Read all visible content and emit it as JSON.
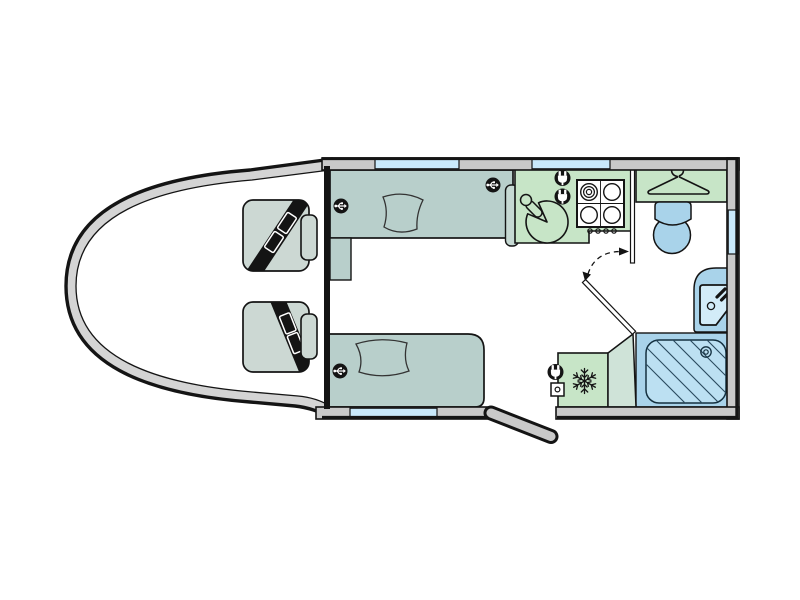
{
  "diagram": {
    "type": "motorhome-floorplan-top-view",
    "colors": {
      "outline": "#141414",
      "thin_line": "#2a2a2a",
      "wall_gray": "#c9c9c9",
      "cab_gray": "#d4d4d4",
      "floor_white": "#ffffff",
      "sofa_teal": "#b8cfcb",
      "sofa_teal_light": "#c6d9d3",
      "seat_gray_green": "#ccd8d3",
      "kitchen_mint": "#c7e5c7",
      "corner_unit_green": "#cfe3d8",
      "fixture_blue": "#a9d3ea",
      "shower_tray_blue": "#bce0f2",
      "basin_inner_blue": "#d3ecf8",
      "window_blue": "#c9e9fb",
      "icon_black": "#141414",
      "icon_white": "#ffffff",
      "hatch_blue": "#2a4a5e"
    },
    "zones": [
      {
        "name": "cab",
        "features": [
          "driver-seat-with-seatbelt",
          "passenger-seat-with-seatbelt",
          "headrests"
        ]
      },
      {
        "name": "lounge",
        "features": [
          "sofa-front-wall",
          "sofa-rear-wall",
          "cushion-x2",
          "usb-outlet-x3",
          "side-unit"
        ]
      },
      {
        "name": "kitchen",
        "features": [
          "round-sink-with-tap",
          "hob-4-burner",
          "hob-control-knobs-x4",
          "power-outlet-x2"
        ]
      },
      {
        "name": "wardrobe",
        "features": [
          "clothes-hanger"
        ]
      },
      {
        "name": "washroom",
        "features": [
          "toilet",
          "washbasin-with-tap",
          "shower-tray-with-drain"
        ]
      },
      {
        "name": "rear-galley",
        "features": [
          "fridge-snowflake",
          "power-outlet",
          "mains-socket"
        ]
      }
    ],
    "openings": {
      "windows_top_wall": 2,
      "windows_bottom_wall": 1,
      "windows_right_wall": 1,
      "entry_door_open_flap": 1,
      "interior_door_with_swing_arc": 1
    }
  }
}
